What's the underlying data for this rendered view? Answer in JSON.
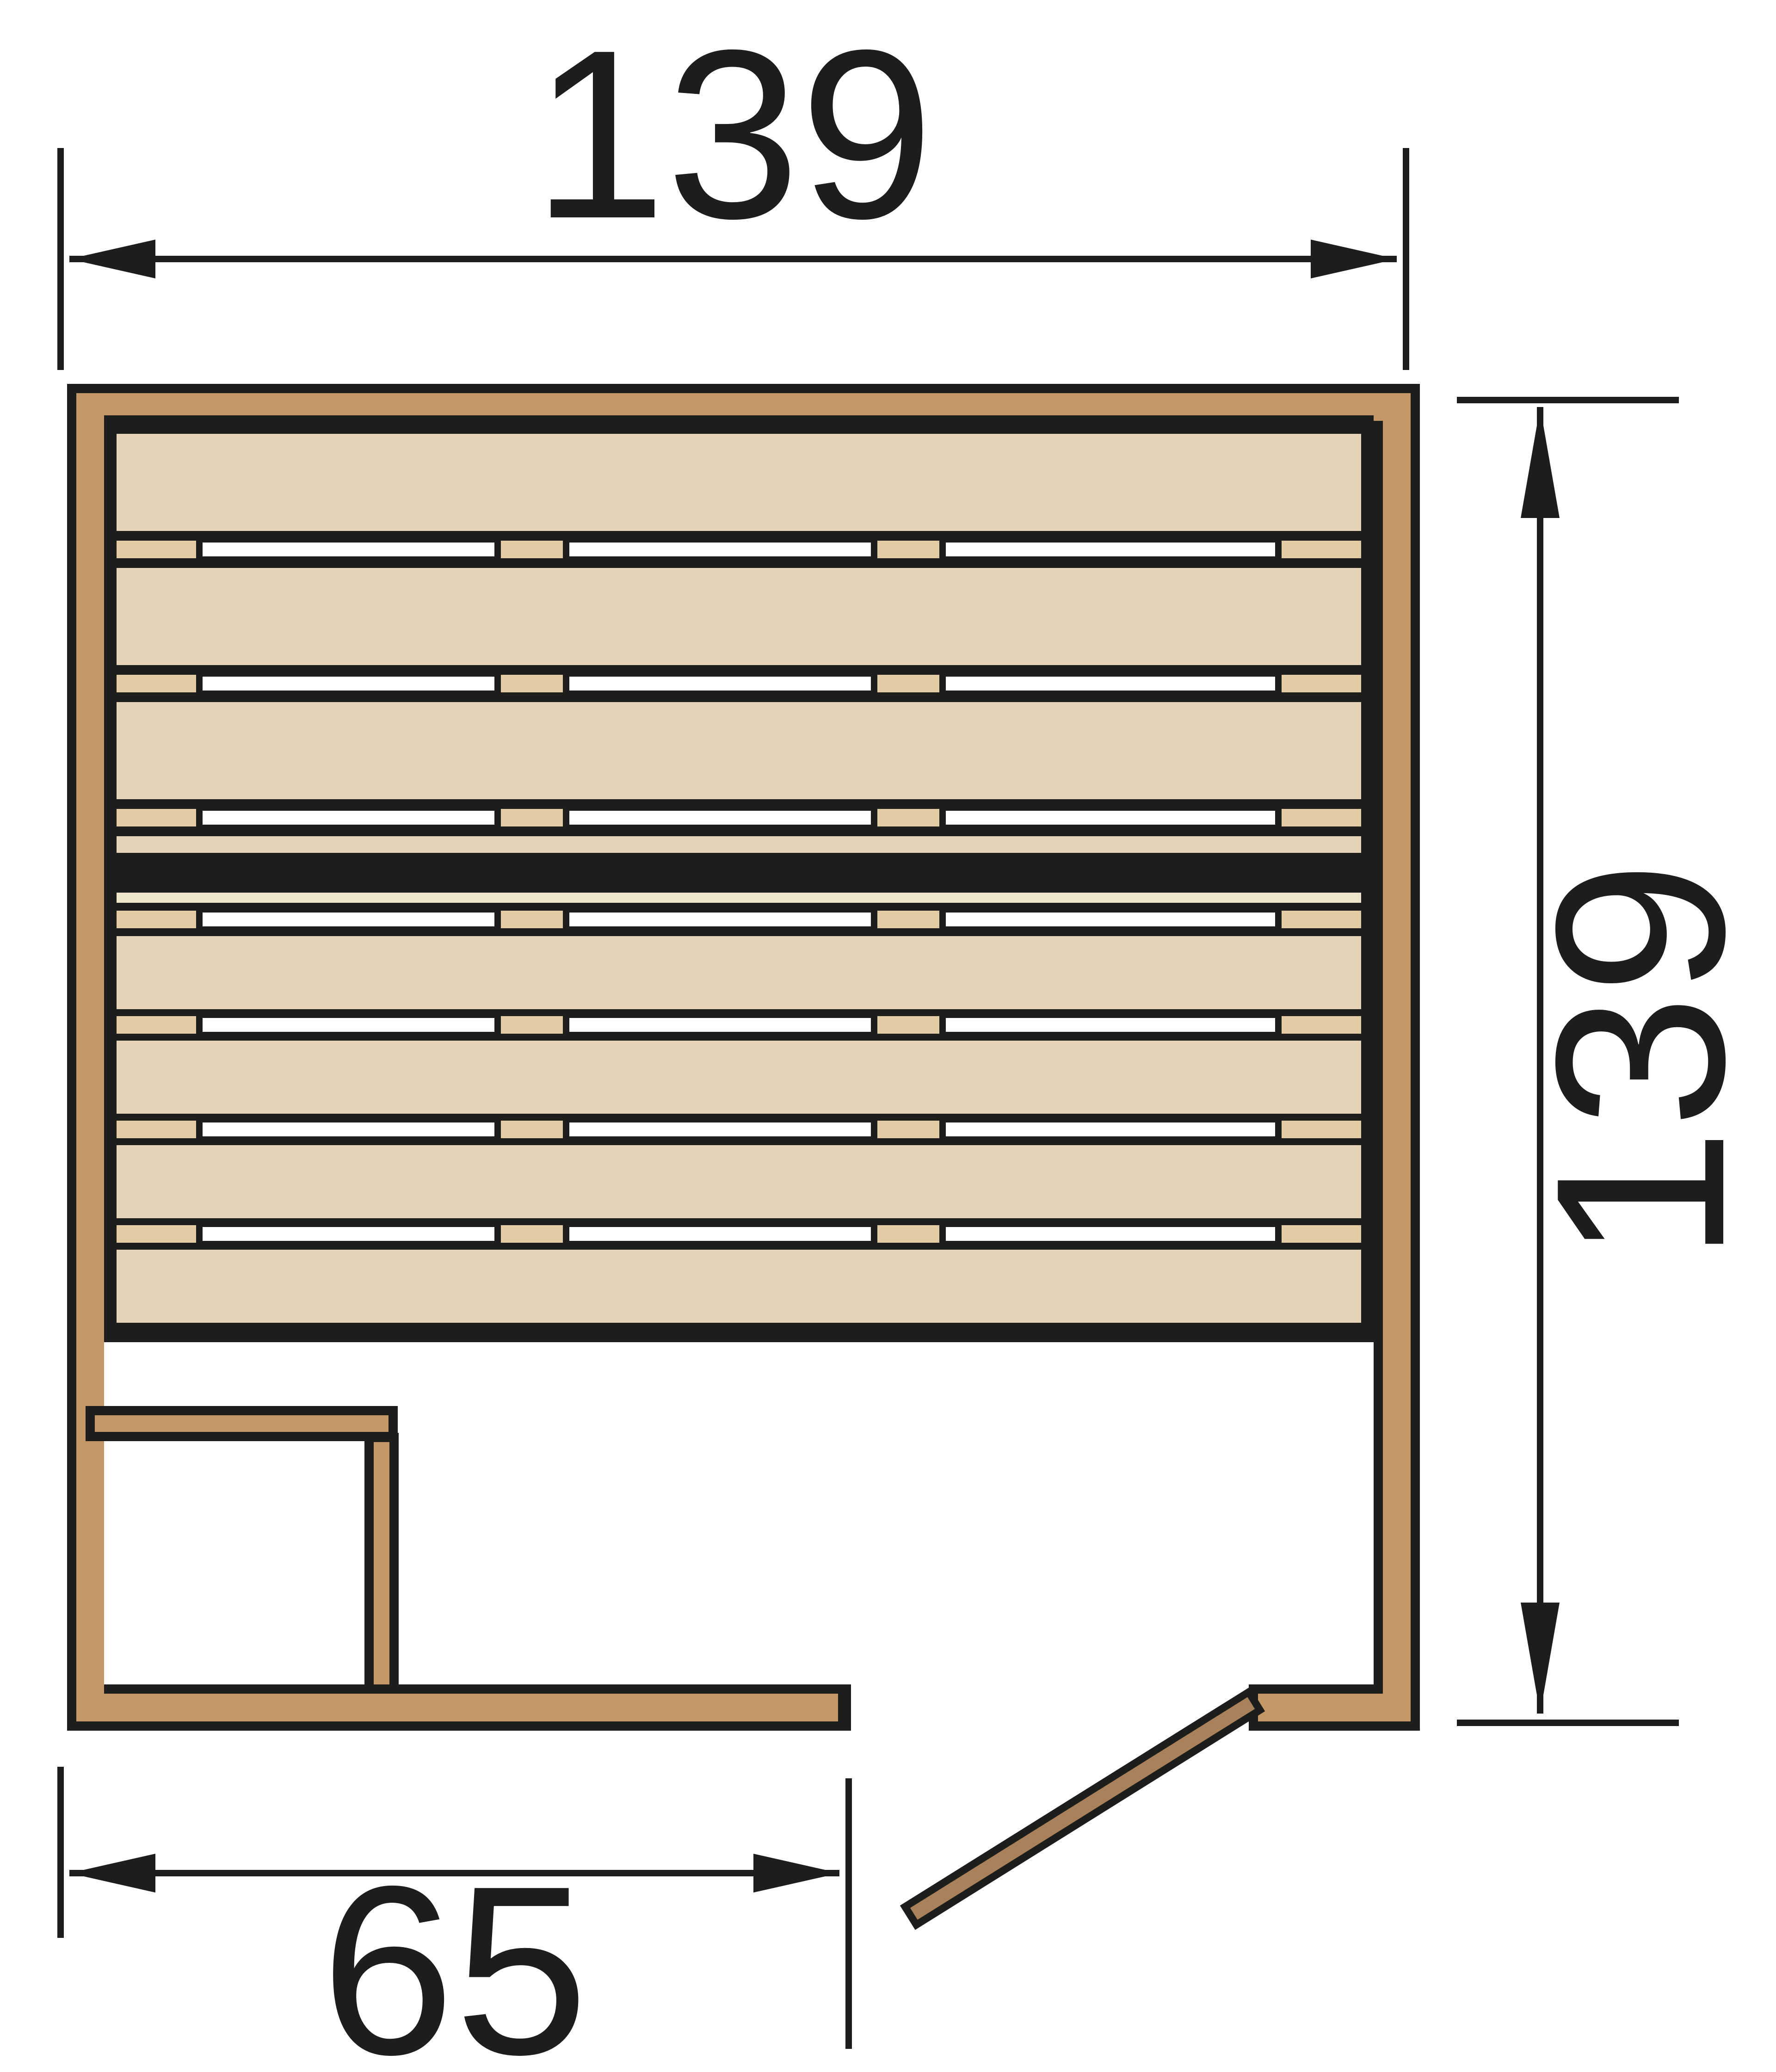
{
  "page": {
    "title": "Sauna floor plan - top view",
    "background": "#FFFFFF"
  },
  "colors": {
    "ink": "#1D1D1B",
    "wall_wood": "#C49767",
    "bench_plank": "#E5D4B8",
    "slat_spacer": "#E3CBA6",
    "band_strip": "#EFE4CC",
    "door_wood": "#A9825B",
    "floor": "#FFFFFF"
  },
  "dimensions": {
    "width": {
      "label": "139",
      "position": "top",
      "unit": "cm"
    },
    "depth": {
      "label": "139",
      "position": "right",
      "unit": "cm"
    },
    "front": {
      "label": "65",
      "position": "bottom-left",
      "unit": "cm"
    }
  },
  "bench": {
    "planks_above_band": 3,
    "planks_below_band": 4,
    "slat_gap_rows": 7,
    "slots_per_gap": 3,
    "spacers_per_gap": 4,
    "center_band": true
  },
  "features": {
    "door": "open, hinged at bottom-right post, swinging outward",
    "corner_bench": "bottom-left L-shaped bench",
    "door_opening": "front wall gap between wall end and corner post"
  }
}
